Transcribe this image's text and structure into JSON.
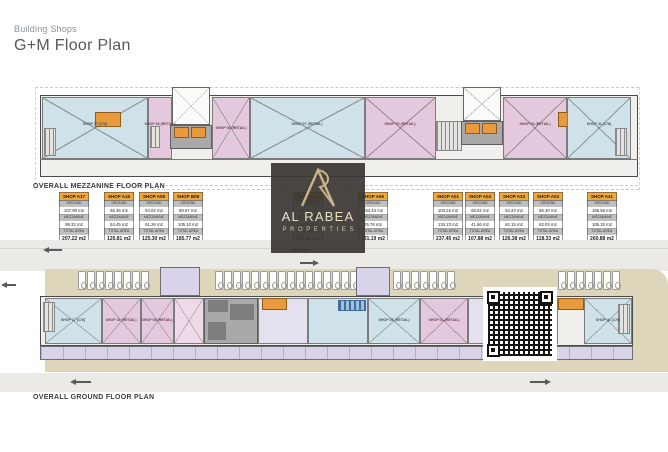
{
  "header": {
    "subtitle": "Building Shops",
    "title": "G+M Floor Plan"
  },
  "watermark": {
    "monogram": "AR",
    "name": "AL RABEA",
    "tagline": "PROPERTIES"
  },
  "plans": {
    "mezzanine": {
      "caption": "OVERALL MEZZANINE FLOOR PLAN",
      "rooms": [
        {
          "label": "SHOP 17 (176)"
        },
        {
          "label": "SHOP 16 (RETAIL)"
        },
        {
          "label": "SHOP 08 (RETAIL)"
        },
        {
          "label": "SHOP 07 (RETAIL)"
        },
        {
          "label": "SHOP 05 (RETAIL)"
        },
        {
          "label": "SHOP 04 (RETAIL)"
        },
        {
          "label": "SHOP 41 (176)"
        }
      ]
    },
    "ground": {
      "caption": "OVERALL GROUND FLOOR PLAN",
      "rooms": [
        {
          "label": "SHOP 17 (176)"
        },
        {
          "label": "SHOP 16 (RETAIL)"
        },
        {
          "label": "SHOP 08 (RETAIL)"
        },
        {
          "label": "SHOP 06 (RETAIL)"
        },
        {
          "label": "SHOP 01 (RETAIL)"
        },
        {
          "label": "SHOP 41 (176)"
        }
      ]
    }
  },
  "area_tables": {
    "row_labels": {
      "ground": "GROUND",
      "mezzanine": "MEZZANINE",
      "total": "TOTAL AREA"
    },
    "shops": [
      {
        "name": "SHOP A17",
        "ground": "107.90 m2",
        "mezzanine": "99.32 m2",
        "total": "207.22 m2"
      },
      {
        "name": "SHOP A16",
        "ground": "66.36 m2",
        "mezzanine": "54.45 m2",
        "total": "120.81 m2"
      },
      {
        "name": "SHOP A08",
        "ground": "64.04 m2",
        "mezzanine": "61.26 m2",
        "total": "125.30 m2"
      },
      {
        "name": "SHOP B08",
        "ground": "80.67 m2",
        "mezzanine": "105.10 m2",
        "total": "185.77 m2"
      },
      {
        "name": "SHOP A07",
        "ground": "88.20 m2",
        "mezzanine": "60.96 m2",
        "total": "149.16 m2"
      },
      {
        "name": "SHOP A06",
        "ground": "154.43 m2",
        "mezzanine": "76.76 m2",
        "total": "231.19 m2"
      },
      {
        "name": "SHOP A01",
        "ground": "103.22 m2",
        "mezzanine": "134.23 m2",
        "total": "237.45 m2"
      },
      {
        "name": "SHOP A04",
        "ground": "66.02 m2",
        "mezzanine": "41.86 m2",
        "total": "107.88 m2"
      },
      {
        "name": "SHOP A33",
        "ground": "64.23 m2",
        "mezzanine": "62.15 m2",
        "total": "126.38 m2"
      },
      {
        "name": "SHOP A03",
        "ground": "56.30 m2",
        "mezzanine": "62.03 m2",
        "total": "118.33 m2"
      },
      {
        "name": "SHOP A41",
        "ground": "155.56 m2",
        "mezzanine": "105.32 m2",
        "total": "260.88 m2"
      }
    ]
  },
  "colors": {
    "table_header_orange": "#f2a73a",
    "retail_pink": "#e4c9de",
    "shop_blue": "#cfe2ea",
    "corridor_lavender": "#d9d3e9",
    "site_beige": "#ded6bb",
    "logo_gold": "#c9b387",
    "logo_dark": "#3a3734"
  }
}
